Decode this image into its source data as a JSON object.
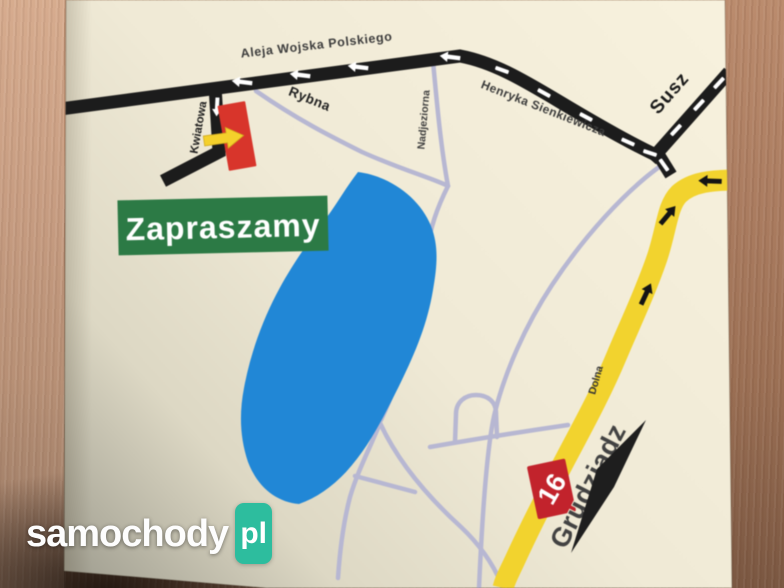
{
  "map": {
    "banner": {
      "label": "Zapraszamy"
    },
    "streets": {
      "aleja_wojska_polskiego": "Aleja Wojska Polskiego",
      "rybna": "Rybna",
      "kwiatowa": "Kwiatowa",
      "nadjeziorna": "Nadjeziorna",
      "henryka_sienkiewicza": "Henryka Sienkiewicza",
      "dolna": "Dolna"
    },
    "destinations": {
      "susz": "Susz",
      "grudziadz": "Grudziądz"
    },
    "route_badge": {
      "number": "16"
    },
    "colors": {
      "paper": "#f0ead6",
      "lake": "#2187d6",
      "main_road": "#1c1c1c",
      "minor_road": "#b7b7d2",
      "route_road": "#f2d32e",
      "marker_red": "#d8352b",
      "arrow_yellow": "#f4d02b",
      "banner_green": "#2c7a45",
      "badge_red": "#c2232c"
    }
  },
  "watermark": {
    "brand": "samochody",
    "suffix": "pl",
    "accent_color": "#2dbd9e"
  }
}
